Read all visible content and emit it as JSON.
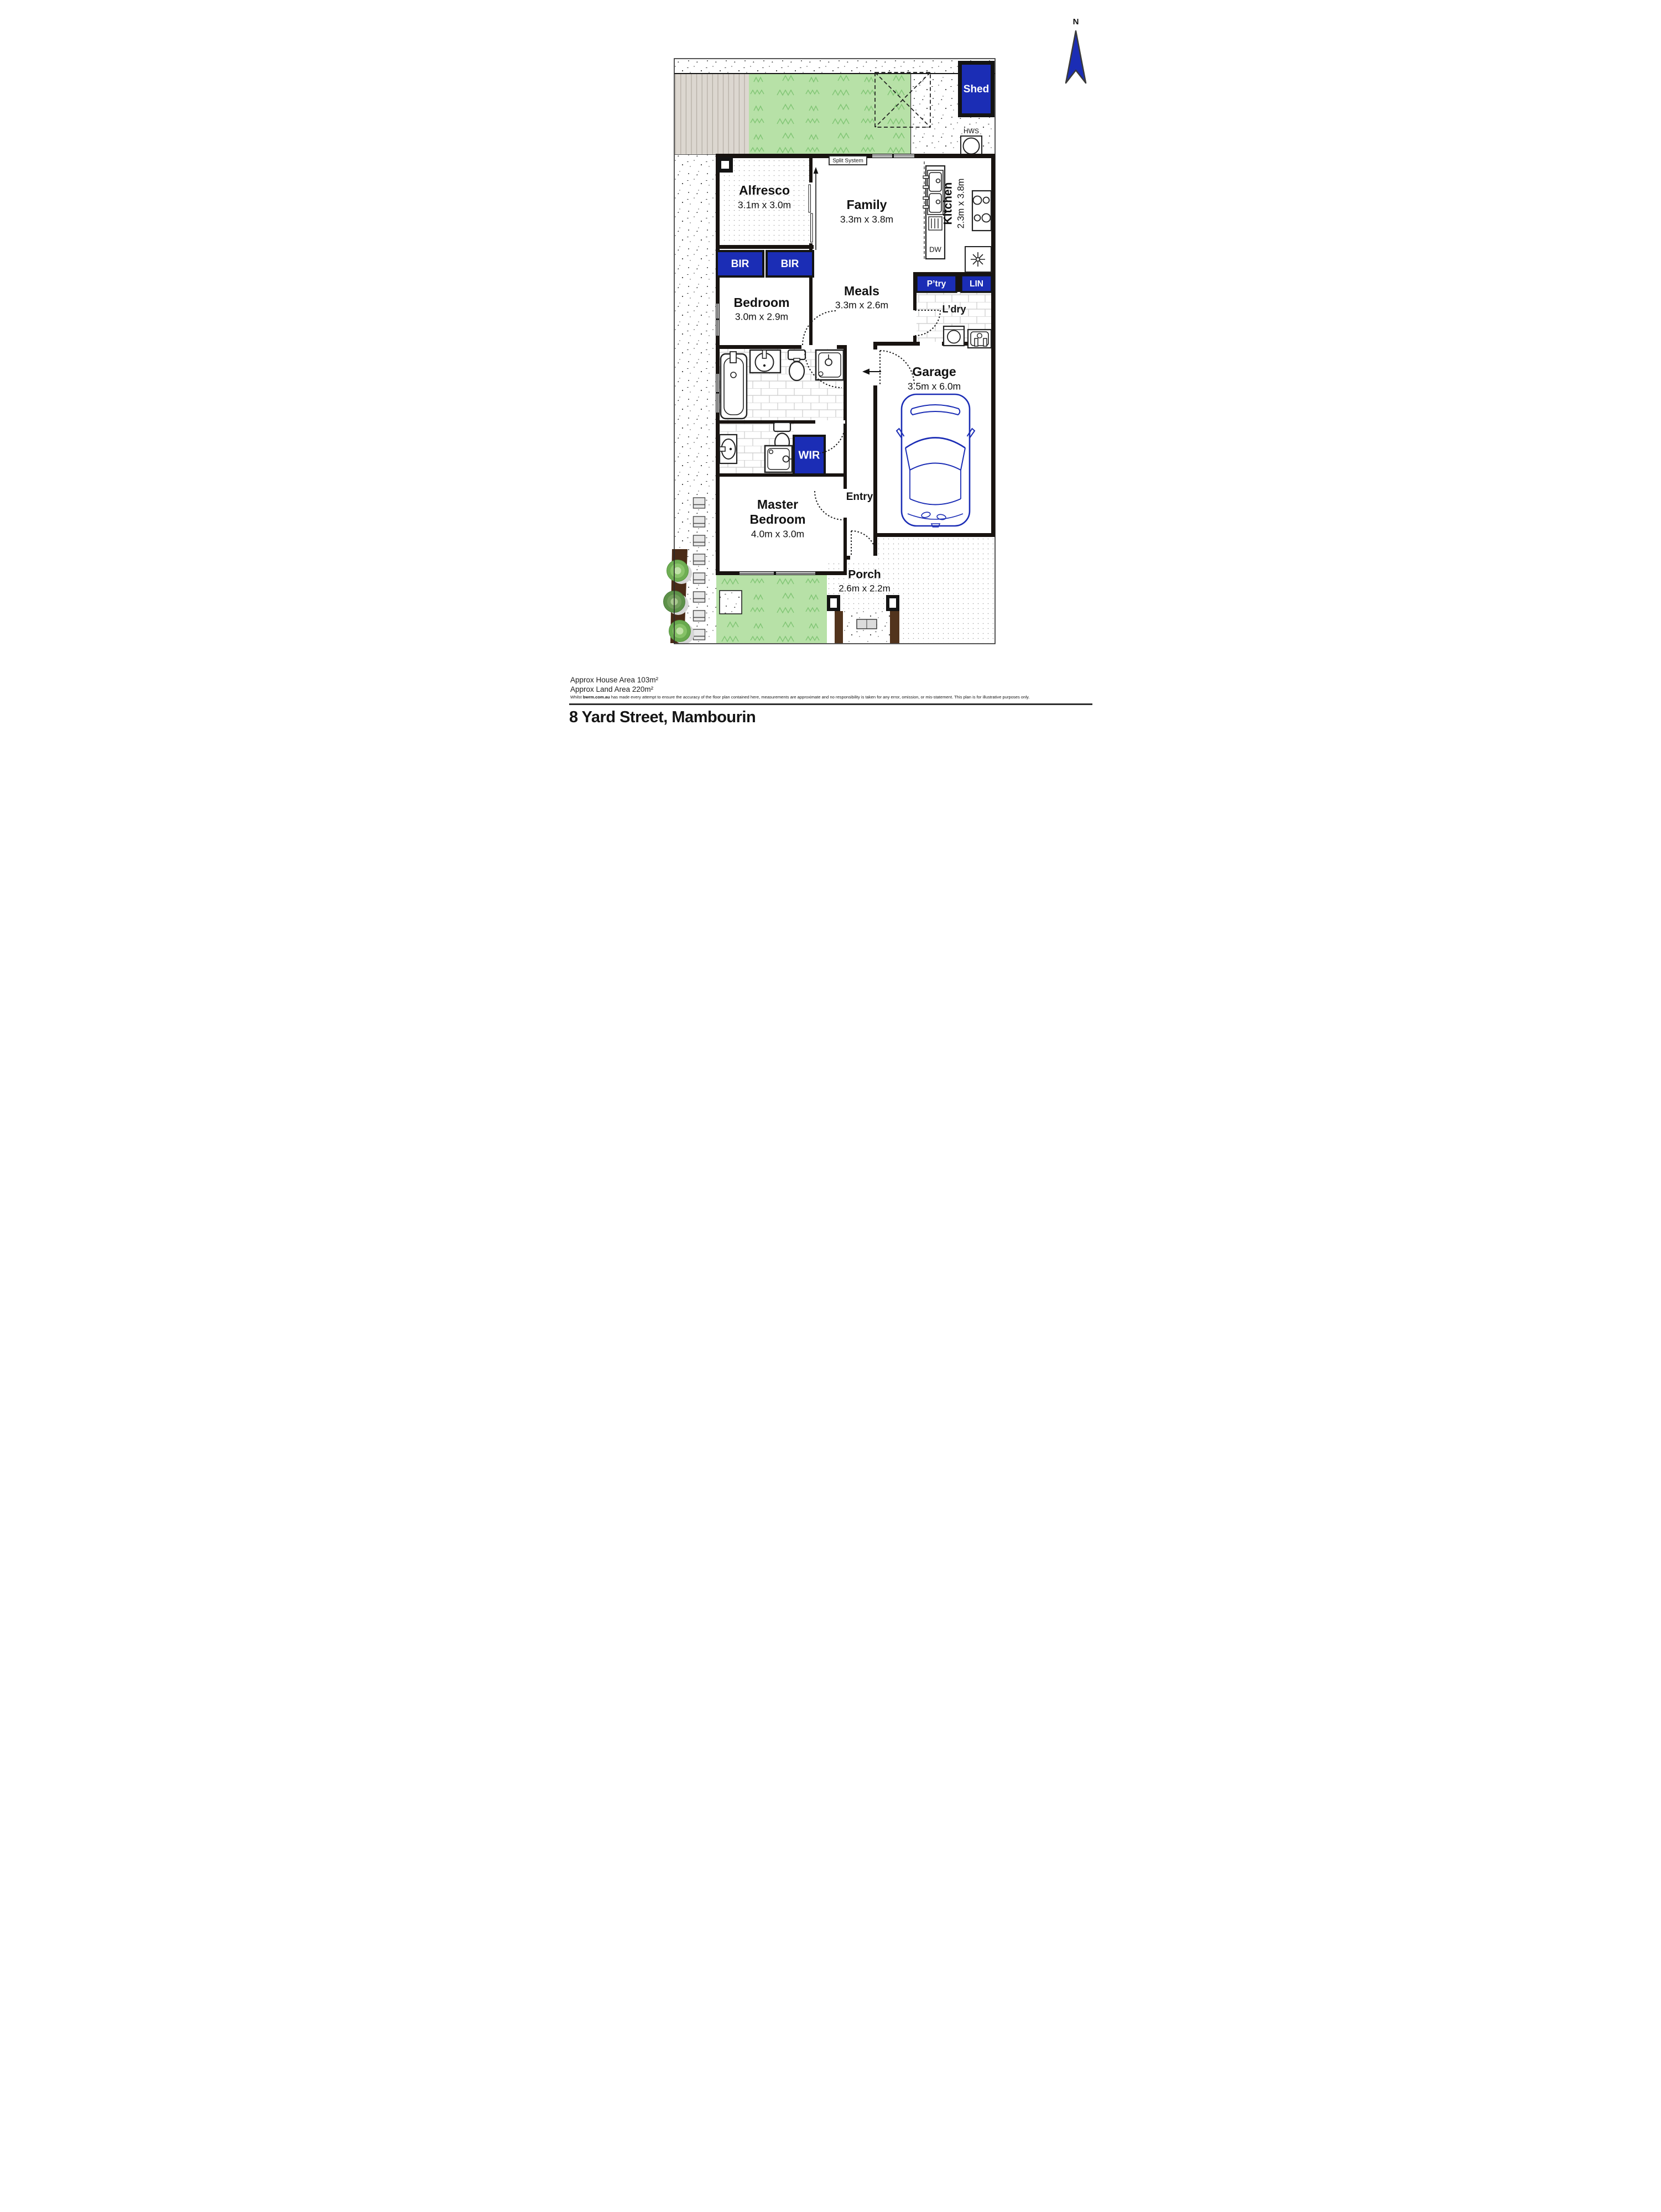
{
  "compass": {
    "label": "N"
  },
  "outdoor": {
    "shed": "Shed",
    "clothesline": "Clothesline",
    "hws": "HWS"
  },
  "fixtures": {
    "split_system": "Split System",
    "dishwasher": "DW"
  },
  "storage": {
    "bir1": "BIR",
    "bir2": "BIR",
    "wir": "WIR",
    "pantry": "P’try",
    "linen": "LIN"
  },
  "rooms": {
    "alfresco": {
      "name": "Alfresco",
      "dims": "3.1m x 3.0m"
    },
    "family": {
      "name": "Family",
      "dims": "3.3m x 3.8m"
    },
    "kitchen": {
      "name": "Kitchen",
      "dims": "2.3m x 3.8m"
    },
    "meals": {
      "name": "Meals",
      "dims": "3.3m x 2.6m"
    },
    "bedroom": {
      "name": "Bedroom",
      "dims": "3.0m x 2.9m"
    },
    "master": {
      "name_line1": "Master",
      "name_line2": "Bedroom",
      "dims": "4.0m x 3.0m"
    },
    "garage": {
      "name": "Garage",
      "dims": "3.5m x 6.0m"
    },
    "laundry": {
      "name": "L’dry"
    },
    "entry": {
      "name": "Entry"
    },
    "porch": {
      "name": "Porch",
      "dims": "2.6m x 2.2m"
    }
  },
  "footer": {
    "house_area": "Approx House Area 103m²",
    "land_area": "Approx Land Area 220m²",
    "disclaimer_prefix": "Whilst ",
    "disclaimer_brand": "bwrm.com.au",
    "disclaimer_suffix": " has made every attempt to ensure the accuracy of the floor plan contained here, measurements are approximate and no responsibility is taken for any error, omission, or mis-statement. This plan is for illustrative purposes only.",
    "address": "8 Yard Street, Mambourin"
  },
  "colors": {
    "accent_blue": "#1b2db5",
    "grass_green": "#b7e1a7",
    "wall_black": "#181310"
  }
}
